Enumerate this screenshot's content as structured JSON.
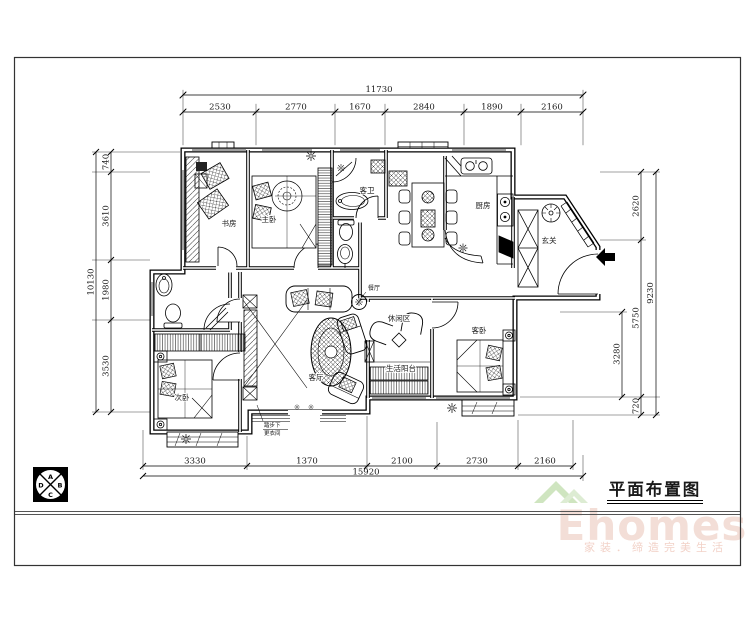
{
  "title": "平面布置图",
  "watermark": {
    "brand": "Ehomes",
    "tagline": "家装．缔造完美生活"
  },
  "marker": {
    "letters": [
      "A",
      "B",
      "C",
      "D"
    ]
  },
  "rooms": {
    "study": "书房",
    "master": "主卧",
    "guest_bath": "客卫",
    "kitchen": "厨房",
    "entry": "玄关",
    "dining": "餐厅",
    "living": "客厅",
    "leisure": "休闲区",
    "balcony": "生活阳台",
    "second": "次卧",
    "guest": "客卧"
  },
  "note": {
    "line1": "踏步下",
    "line2": "更衣间"
  },
  "dims": {
    "top": {
      "total": "11730",
      "segments": [
        "2530",
        "2770",
        "1670",
        "2840",
        "1890",
        "2160"
      ]
    },
    "bottom": {
      "total": "15920",
      "segments": [
        "3330",
        "1370",
        "2100",
        "2730",
        "2160"
      ]
    },
    "left": {
      "total": "10130",
      "segments": [
        "740",
        "3610",
        "1980",
        "3530"
      ]
    },
    "right": {
      "total": "9230",
      "segments": [
        "2620",
        "5750",
        "720"
      ],
      "inner": "3280"
    }
  }
}
